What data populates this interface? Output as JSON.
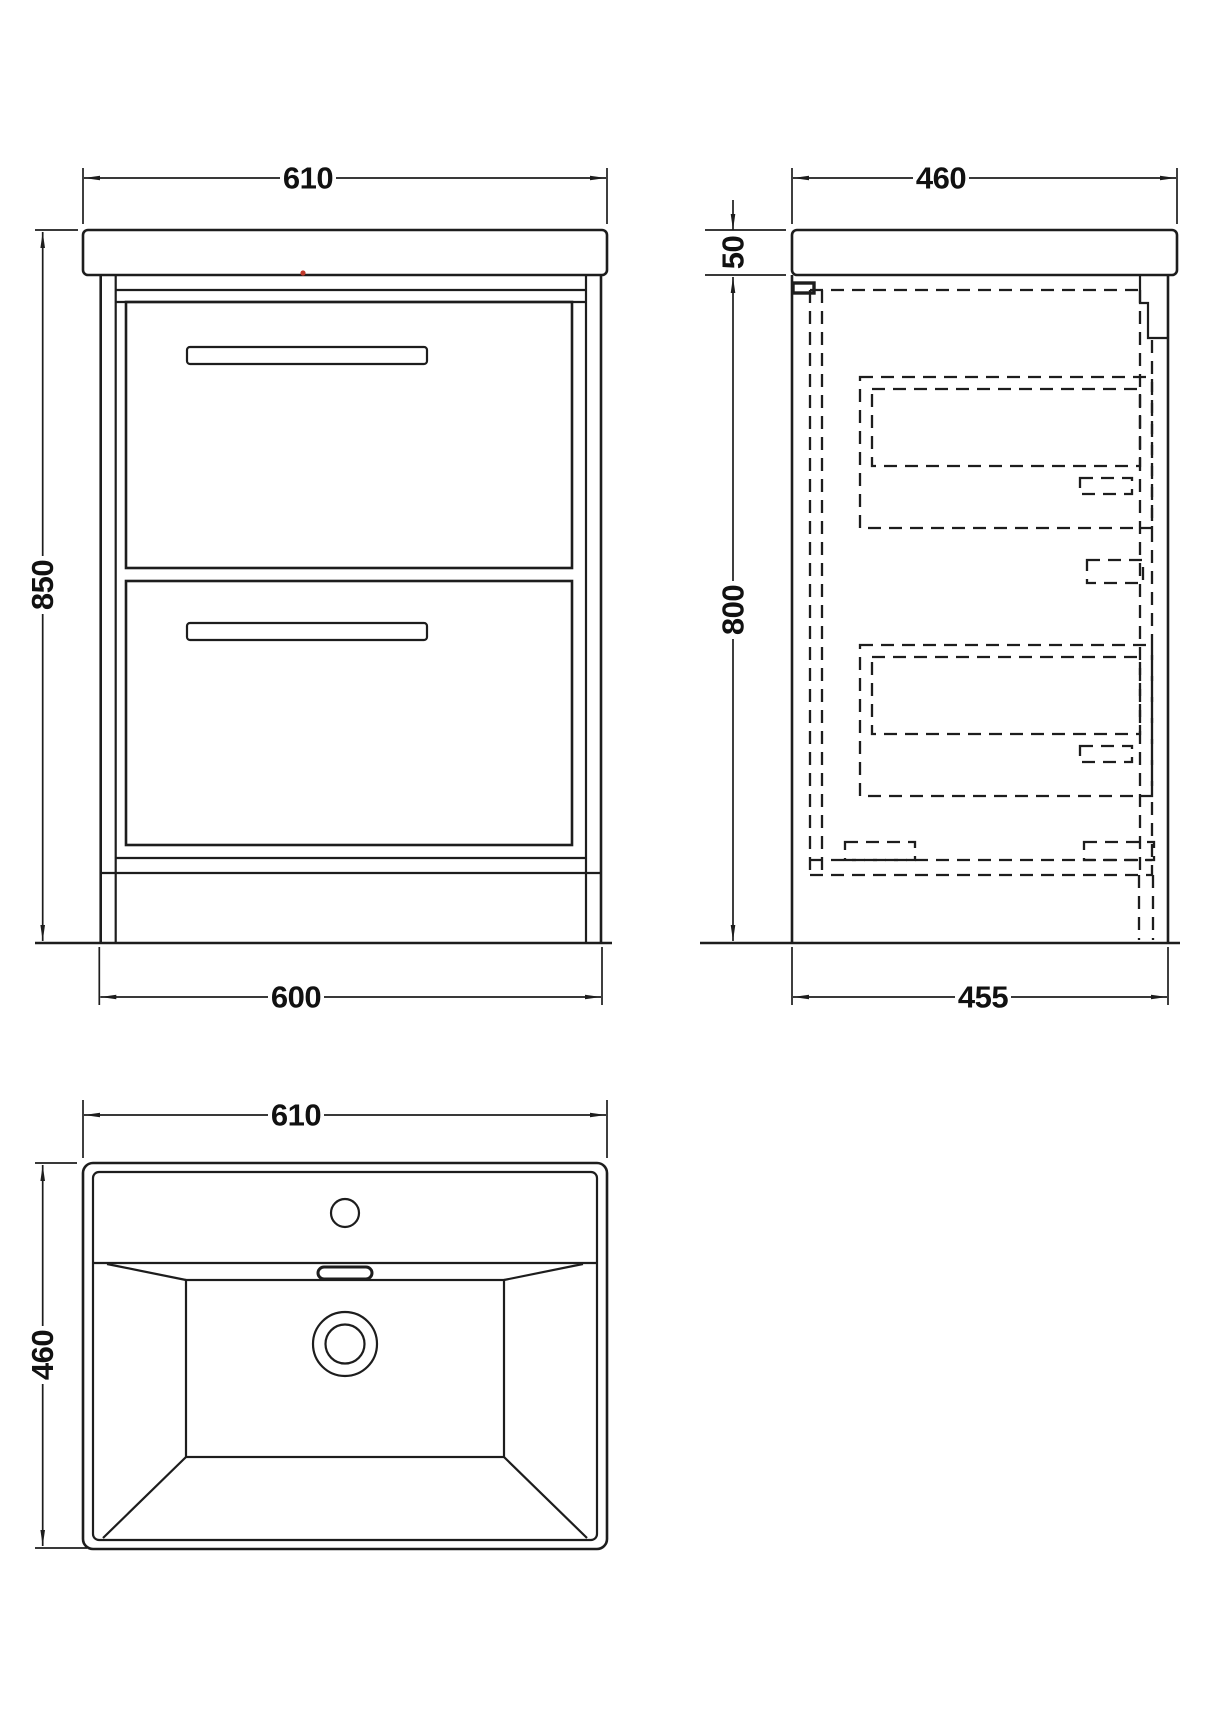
{
  "drawing": {
    "type": "technical-dimension-drawing",
    "subject": "vanity unit with basin - front, side and plan views",
    "colors": {
      "line": "#1d1d1d",
      "background": "#ffffff",
      "red_mark": "#c0392b"
    },
    "dims": {
      "front_width_top": "610",
      "front_height": "850",
      "front_width_bottom": "600",
      "side_depth_top": "460",
      "side_top_thickness": "50",
      "side_height": "800",
      "side_depth_bottom": "455",
      "plan_width": "610",
      "plan_depth": "460"
    }
  }
}
